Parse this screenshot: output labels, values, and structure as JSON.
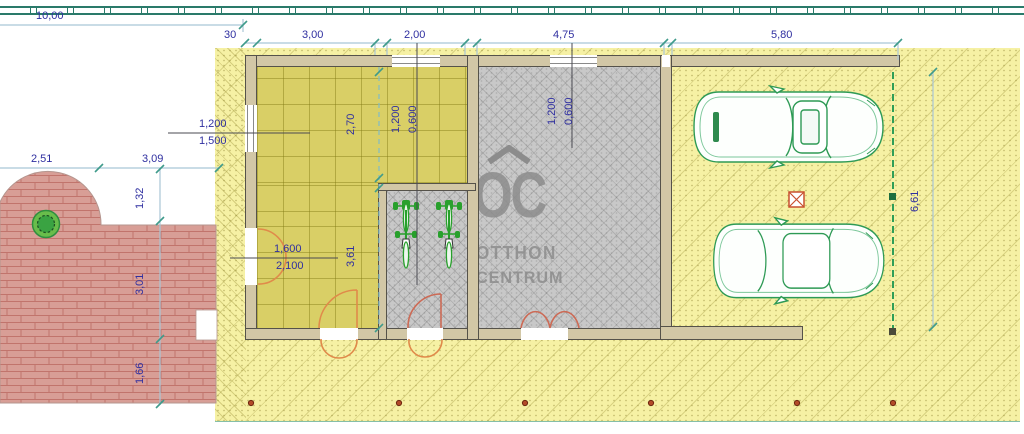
{
  "plan": {
    "watermark": {
      "logo": "OC",
      "brand_line1": "OTTHON",
      "brand_line2": "CENTRUM"
    },
    "dimensions": {
      "overall_top": "10,00",
      "top_chain": [
        "30",
        "3,00",
        "2,00",
        "4,75",
        "5,80"
      ],
      "left_horizontal": [
        "2,51",
        "3,09"
      ],
      "left_vertical": [
        "1,32",
        "3,01",
        "1,66"
      ],
      "right_vertical": "6,61",
      "interior_vertical": [
        "2,70",
        "3,61"
      ]
    },
    "opening_labels": {
      "left_window": {
        "width": "1,200",
        "sill": "1,500"
      },
      "left_door": {
        "width": "1,600",
        "height": "2,100"
      },
      "top_window_1": {
        "width": "1,200",
        "sill": "0,600"
      },
      "top_window_2": {
        "width": "1,200",
        "sill": "0,600"
      }
    },
    "colors": {
      "plot_fill": "#f6f1a4",
      "living_floor": "#d9cf66",
      "tiled_floor": "#c8c8c8",
      "wall_fill": "#d2c7a6",
      "terrace_fill": "#d89e96",
      "dimension_text": "#2f2fa0",
      "door_swing": "#e08a4a",
      "car_outline": "#2e9a55",
      "fence_line": "#2a7a6a",
      "watermark_gray": "#989898",
      "boundary_dashed": "#2f9e57",
      "marker_red": "#c8502e"
    }
  }
}
